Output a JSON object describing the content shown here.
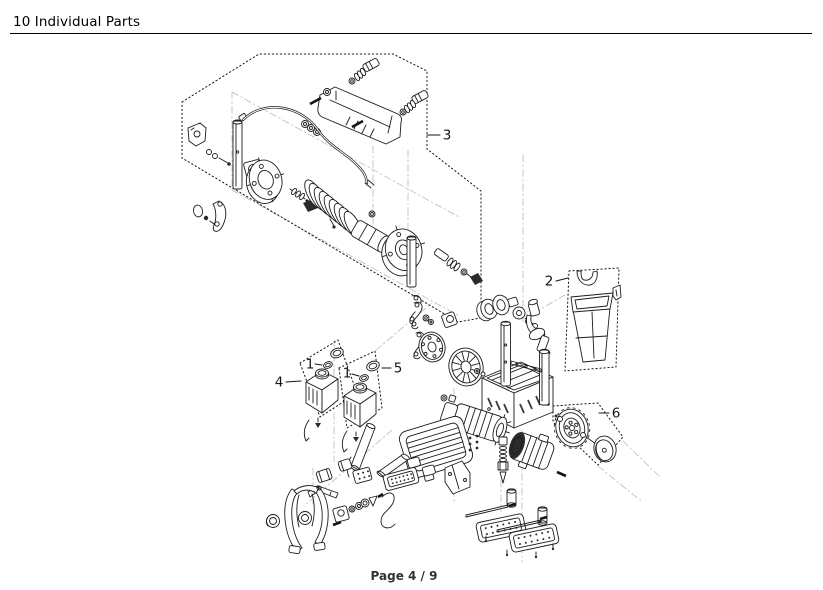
{
  "header": {
    "title": "10 Individual Parts"
  },
  "footer": {
    "page_label": "Page 4 / 9"
  },
  "colors": {
    "background": "#ffffff",
    "ink": "#1c1c1c",
    "guide_line": "#bababa",
    "header_rule": "#000000",
    "footer_text": "#333333"
  },
  "diagram": {
    "type": "exploded-parts-diagram",
    "callouts": [
      {
        "id": "callout-3",
        "label": "3"
      },
      {
        "id": "callout-2",
        "label": "2"
      },
      {
        "id": "callout-4",
        "label": "4"
      },
      {
        "id": "callout-5",
        "label": "5"
      },
      {
        "id": "callout-6",
        "label": "6"
      },
      {
        "id": "callout-1-left",
        "label": "1"
      },
      {
        "id": "callout-1-right",
        "label": "1"
      }
    ]
  }
}
